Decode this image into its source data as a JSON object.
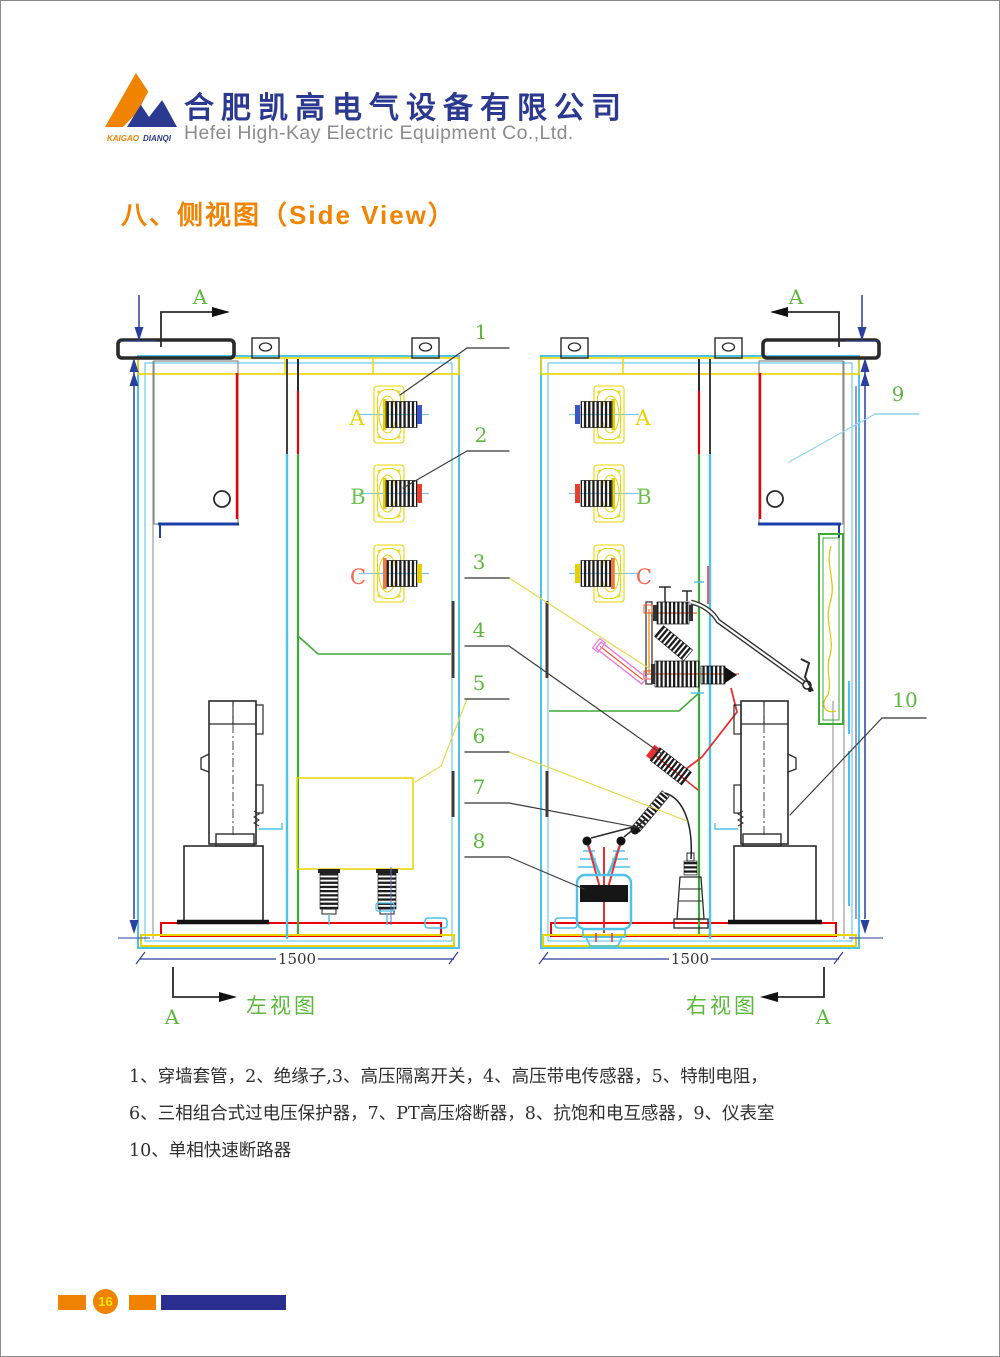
{
  "header": {
    "logo": {
      "word1": "KAIGAO",
      "word2": "DIANQI"
    },
    "company_cn": "合肥凯高电气设备有限公司",
    "company_en": "Hefei High-Kay Electric Equipment Co.,Ltd."
  },
  "title": "八、侧视图（Side View）",
  "drawing": {
    "section_letter": "A",
    "dim_width": "1500",
    "left_view_label": "左视图",
    "right_view_label": "右视图",
    "phases": [
      "A",
      "B",
      "C"
    ],
    "callouts": [
      "1",
      "2",
      "3",
      "4",
      "5",
      "6",
      "7",
      "8",
      "9",
      "10"
    ]
  },
  "legend": {
    "line1": "1、穿墙套管，2、绝缘子,3、高压隔离开关，4、高压带电传感器，5、特制电阻，",
    "line2": "6、三相组合式过电压保护器，7、PT高压熔断器，8、抗饱和电互感器，9、仪表室",
    "line3": "10、单相快速断路器"
  },
  "footer": {
    "page_number": "16"
  },
  "colors": {
    "accent_orange": "#F08300",
    "brand_blue": "#2B3990",
    "callout_green": "#5CB83C",
    "frame_cyan": "#4FC2E9",
    "frame_yellow": "#E9D400",
    "dim_blue": "#2B3F9E",
    "alert_red": "#E8000A"
  }
}
